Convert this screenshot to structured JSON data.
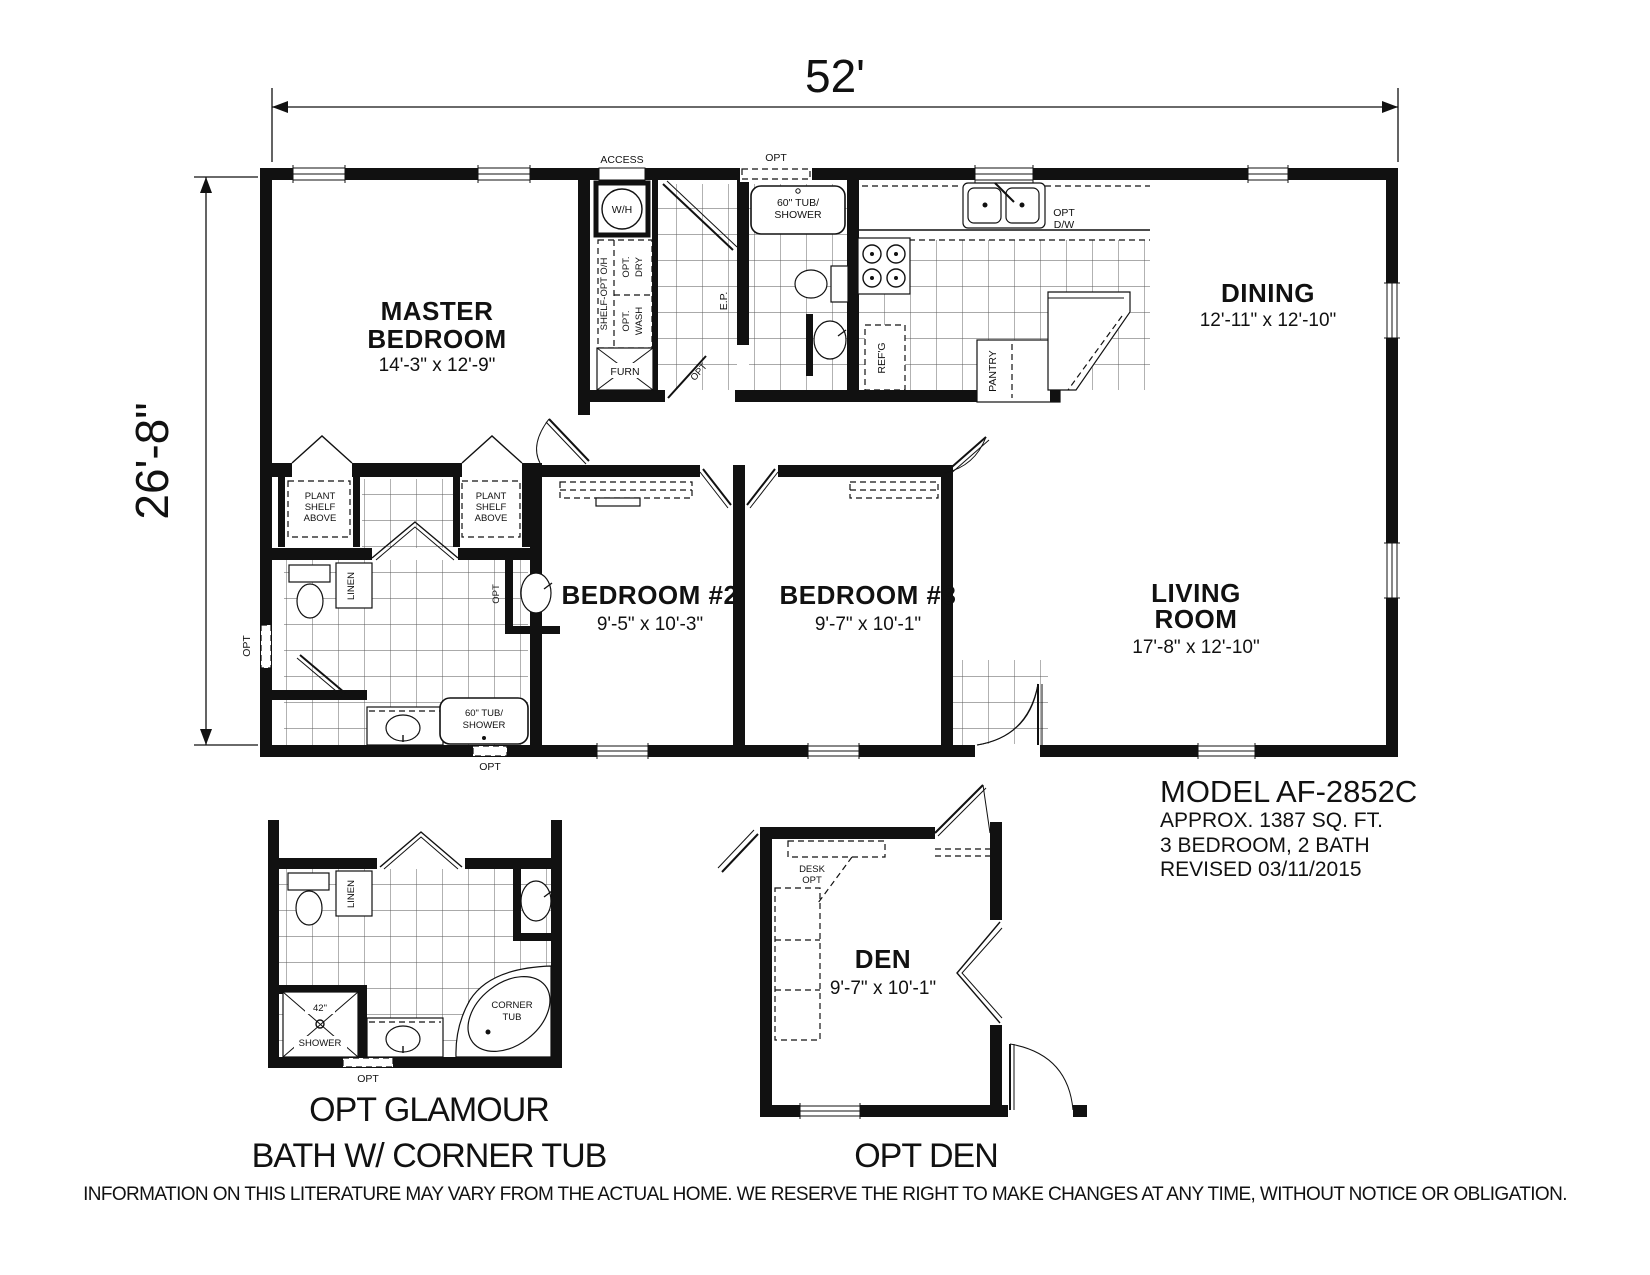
{
  "plan": {
    "width_label": "52'",
    "height_label": "26'-8\"",
    "rooms": {
      "master_bedroom": {
        "line1": "MASTER",
        "line2": "BEDROOM",
        "dims": "14'-3\" x 12'-9\""
      },
      "dining": {
        "line1": "DINING",
        "dims": "12'-11\" x 12'-10\""
      },
      "bedroom2": {
        "line1": "BEDROOM #2",
        "dims": "9'-5\" x 10'-3\""
      },
      "bedroom3": {
        "line1": "BEDROOM #3",
        "dims": "9'-7\" x 10'-1\""
      },
      "living": {
        "line1": "LIVING",
        "line2": "ROOM",
        "dims": "17'-8\" x 12'-10\""
      },
      "den": {
        "line1": "DEN",
        "dims": "9'-7\" x 10'-1\""
      }
    },
    "labels": {
      "access": "ACCESS",
      "wh": "W/H",
      "shelf_oh": "SHELF-OPT O/H",
      "opt": "OPT",
      "opt_dot": "OPT.",
      "dry": "DRY",
      "wash": "WASH",
      "furn": "FURN",
      "ep": "E.P.",
      "tub1": "60\" TUB/",
      "tub2": "SHOWER",
      "dw": "D/W",
      "refg": "REF'G",
      "pantry": "PANTRY",
      "linen": "LINEN",
      "plant1": "PLANT",
      "plant2": "SHELF",
      "plant3": "ABOVE",
      "shower42": "42\"",
      "shower": "SHOWER",
      "corner1": "CORNER",
      "corner2": "TUB",
      "desk": "DESK"
    }
  },
  "title_block": {
    "model": "MODEL AF-2852C",
    "area": "APPROX. 1387 SQ. FT.",
    "rooms": "3 BEDROOM, 2 BATH",
    "revised": "REVISED 03/11/2015"
  },
  "captions": {
    "glamour1": "OPT GLAMOUR",
    "glamour2": "BATH W/ CORNER TUB",
    "den": "OPT DEN"
  },
  "disclaimer": "INFORMATION ON THIS LITERATURE MAY VARY FROM THE ACTUAL HOME. WE RESERVE THE RIGHT TO MAKE CHANGES AT ANY TIME, WITHOUT NOTICE OR OBLIGATION.",
  "colors": {
    "line": "#111111",
    "bg": "#ffffff",
    "tile": "#555555"
  }
}
